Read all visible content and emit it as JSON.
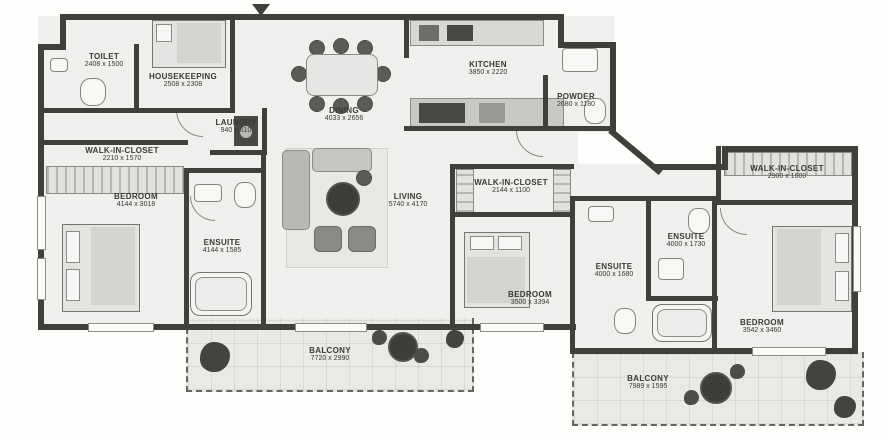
{
  "plan": {
    "type": "apartment-floor-plan",
    "colors": {
      "wall": "#413f3c",
      "floor": "#f0efed",
      "text": "#3a3936",
      "balcony_edge": "#67655f"
    }
  },
  "rooms": [
    {
      "name": "TOILET",
      "dims": "2408 x 1500"
    },
    {
      "name": "HOUSEKEEPING",
      "dims": "2508 x 2308"
    },
    {
      "name": "LAUNDRY",
      "dims": "940 x 610"
    },
    {
      "name": "DINING",
      "dims": "4033 x 2656"
    },
    {
      "name": "KITCHEN",
      "dims": "3850 x 2220"
    },
    {
      "name": "POWDER",
      "dims": "2680 x 1180"
    },
    {
      "name": "WALK-IN-CLOSET",
      "dims": "2210 x 1570"
    },
    {
      "name": "BEDROOM",
      "dims": "4144 x 3018"
    },
    {
      "name": "ENSUITE",
      "dims": "4144 x 1585"
    },
    {
      "name": "LIVING",
      "dims": "5740 x 4170"
    },
    {
      "name": "WALK-IN-CLOSET",
      "dims": "2144 x 1100"
    },
    {
      "name": "BEDROOM",
      "dims": "3500 x 3394"
    },
    {
      "name": "ENSUITE",
      "dims": "4000 x 1680"
    },
    {
      "name": "ENSUITE",
      "dims": "4000 x 1730"
    },
    {
      "name": "WALK-IN-CLOSET",
      "dims": "2900 x 1600"
    },
    {
      "name": "BEDROOM",
      "dims": "3542 x 3460"
    },
    {
      "name": "BALCONY",
      "dims": "7720 x 2990"
    },
    {
      "name": "BALCONY",
      "dims": "7989 x 1595"
    }
  ]
}
